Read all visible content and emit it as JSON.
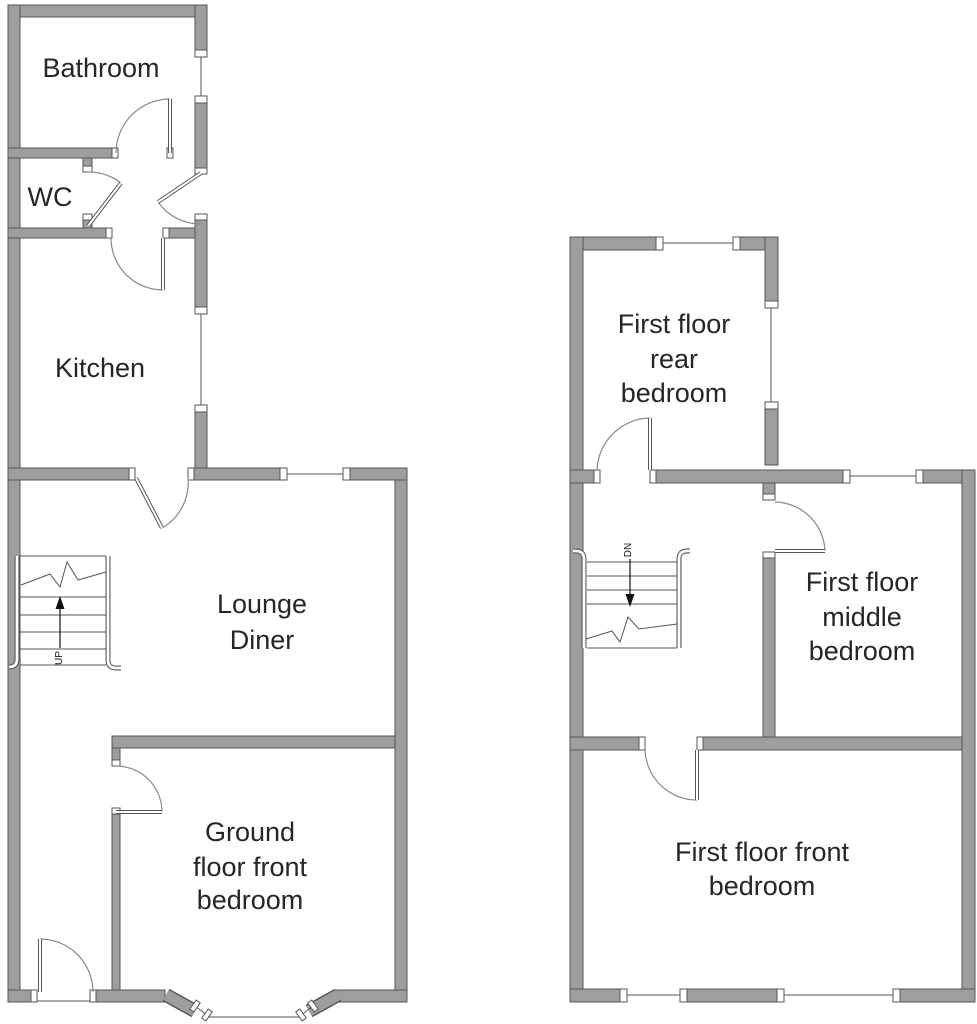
{
  "palette": {
    "background": "#ffffff",
    "wall_fill": "#9e9e9e",
    "wall_edge": "#555555",
    "door_arc": "#8a8a8a",
    "text": "#262626"
  },
  "ground_floor": {
    "rooms": {
      "bathroom": {
        "label": "Bathroom"
      },
      "wc": {
        "label": "WC"
      },
      "kitchen": {
        "label": "Kitchen"
      },
      "lounge_diner": {
        "lines": [
          "Lounge",
          "Diner"
        ]
      },
      "front_bedroom": {
        "lines": [
          "Ground",
          "floor front",
          "bedroom"
        ]
      }
    },
    "stairs": {
      "label": "UP"
    }
  },
  "first_floor": {
    "rooms": {
      "rear_bedroom": {
        "lines": [
          "First floor",
          "rear",
          "bedroom"
        ]
      },
      "middle_bedroom": {
        "lines": [
          "First floor",
          "middle",
          "bedroom"
        ]
      },
      "front_bedroom": {
        "lines": [
          "First floor front",
          "bedroom"
        ]
      }
    },
    "stairs": {
      "label": "DN"
    }
  }
}
